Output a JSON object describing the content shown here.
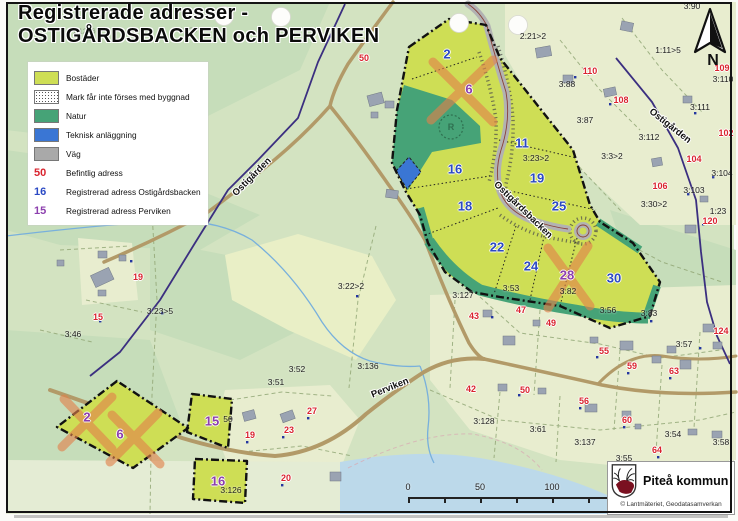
{
  "title": {
    "line1": "Registrerade adresser -",
    "line2": "OSTIGÅRDSBACKEN och PERVIKEN"
  },
  "legend": {
    "items": [
      {
        "type": "bostader",
        "label": "Bostäder"
      },
      {
        "type": "prickmark",
        "label": "Mark får inte förses med byggnad"
      },
      {
        "type": "natur",
        "label": "Natur"
      },
      {
        "type": "teknisk",
        "label": "Teknisk anläggning"
      },
      {
        "type": "vag",
        "label": "Väg"
      },
      {
        "type": "text",
        "color": "red",
        "symbol": "50",
        "label": "Befintlig adress"
      },
      {
        "type": "text",
        "color": "blue",
        "symbol": "16",
        "label": "Registrerad adress Ostigårdsbacken"
      },
      {
        "type": "text",
        "color": "purple",
        "symbol": "15",
        "label": "Registrerad adress Perviken"
      }
    ]
  },
  "colors": {
    "bostader": "#cede55",
    "natur": "#46a377",
    "teknisk": "#3a76d4",
    "vag": "#b2b2b2",
    "befintlig_adress": "#d9232e",
    "adress_ostigardsbacken": "#2b49c4",
    "adress_perviken": "#8c3fae",
    "road_minor": "#b29a68",
    "water": "#bcd9ea",
    "cross_out": "#e2814b"
  },
  "north": {
    "label": "N"
  },
  "scalebar": {
    "labels": [
      {
        "t": "0",
        "x": 8
      },
      {
        "t": "50",
        "x": 80
      },
      {
        "t": "100",
        "x": 152
      },
      {
        "t": "200 m",
        "x": 290
      }
    ]
  },
  "attribution": {
    "municipality": "Piteå kommun",
    "copyright": "© Lantmäteriet, Geodatasamverkan"
  },
  "road_labels": [
    {
      "t": "Ostigården",
      "x": 252,
      "y": 177,
      "r": -45
    },
    {
      "t": "Ostigårdsbacken",
      "x": 523,
      "y": 210,
      "r": 44
    },
    {
      "t": "Ostigården",
      "x": 670,
      "y": 126,
      "r": 38
    },
    {
      "t": "Perviken",
      "x": 390,
      "y": 388,
      "r": -22
    }
  ],
  "parcel_numbers": {
    "ostigardsbacken": [
      {
        "t": "2",
        "x": 447,
        "y": 54
      },
      {
        "t": "11",
        "x": 522,
        "y": 143
      },
      {
        "t": "16",
        "x": 455,
        "y": 169
      },
      {
        "t": "19",
        "x": 537,
        "y": 178
      },
      {
        "t": "18",
        "x": 465,
        "y": 206
      },
      {
        "t": "25",
        "x": 559,
        "y": 206
      },
      {
        "t": "22",
        "x": 497,
        "y": 247
      },
      {
        "t": "24",
        "x": 531,
        "y": 266
      },
      {
        "t": "30",
        "x": 614,
        "y": 278
      }
    ],
    "perviken": [
      {
        "t": "6",
        "x": 469,
        "y": 89
      },
      {
        "t": "28",
        "x": 567,
        "y": 275
      },
      {
        "t": "2",
        "x": 87,
        "y": 417
      },
      {
        "t": "6",
        "x": 120,
        "y": 434
      },
      {
        "t": "15",
        "x": 212,
        "y": 421
      },
      {
        "t": "16",
        "x": 218,
        "y": 481
      }
    ]
  },
  "existing_addresses_red": [
    {
      "t": "50",
      "x": 364,
      "y": 58
    },
    {
      "t": "110",
      "x": 590,
      "y": 71
    },
    {
      "t": "109",
      "x": 722,
      "y": 68
    },
    {
      "t": "108",
      "x": 621,
      "y": 100
    },
    {
      "t": "102",
      "x": 726,
      "y": 133
    },
    {
      "t": "104",
      "x": 694,
      "y": 159
    },
    {
      "t": "106",
      "x": 660,
      "y": 186
    },
    {
      "t": "120",
      "x": 710,
      "y": 221
    },
    {
      "t": "124",
      "x": 721,
      "y": 331
    },
    {
      "t": "43",
      "x": 474,
      "y": 316
    },
    {
      "t": "47",
      "x": 521,
      "y": 310
    },
    {
      "t": "49",
      "x": 551,
      "y": 323
    },
    {
      "t": "55",
      "x": 604,
      "y": 351
    },
    {
      "t": "59",
      "x": 632,
      "y": 366
    },
    {
      "t": "63",
      "x": 674,
      "y": 371
    },
    {
      "t": "50",
      "x": 525,
      "y": 390
    },
    {
      "t": "56",
      "x": 584,
      "y": 401
    },
    {
      "t": "60",
      "x": 627,
      "y": 420
    },
    {
      "t": "64",
      "x": 657,
      "y": 450
    },
    {
      "t": "42",
      "x": 471,
      "y": 389
    },
    {
      "t": "27",
      "x": 312,
      "y": 411
    },
    {
      "t": "23",
      "x": 289,
      "y": 430
    },
    {
      "t": "19",
      "x": 250,
      "y": 435
    },
    {
      "t": "20",
      "x": 286,
      "y": 478
    },
    {
      "t": "19",
      "x": 138,
      "y": 277
    },
    {
      "t": "15",
      "x": 98,
      "y": 317
    },
    {
      "t": "6",
      "x": 731,
      "y": 464
    }
  ],
  "property_labels": [
    {
      "t": "2:21>2",
      "x": 533,
      "y": 36
    },
    {
      "t": "3:90",
      "x": 692,
      "y": 6
    },
    {
      "t": "1:11>5",
      "x": 668,
      "y": 50
    },
    {
      "t": "3:110",
      "x": 723,
      "y": 79
    },
    {
      "t": "3:111",
      "x": 700,
      "y": 107
    },
    {
      "t": "3:112",
      "x": 649,
      "y": 137
    },
    {
      "t": "3:88",
      "x": 567,
      "y": 84
    },
    {
      "t": "3:87",
      "x": 585,
      "y": 120
    },
    {
      "t": "3:104",
      "x": 722,
      "y": 173
    },
    {
      "t": "3:103",
      "x": 694,
      "y": 190
    },
    {
      "t": "3:30>2",
      "x": 654,
      "y": 204
    },
    {
      "t": "1:23",
      "x": 718,
      "y": 211
    },
    {
      "t": "3:3>2",
      "x": 612,
      "y": 156
    },
    {
      "t": "3:23>2",
      "x": 536,
      "y": 158
    },
    {
      "t": "3:22>2",
      "x": 351,
      "y": 286
    },
    {
      "t": "3:127",
      "x": 463,
      "y": 295
    },
    {
      "t": "3:53",
      "x": 511,
      "y": 288
    },
    {
      "t": "3:82",
      "x": 568,
      "y": 291
    },
    {
      "t": "3:56",
      "x": 608,
      "y": 310
    },
    {
      "t": "3:83",
      "x": 649,
      "y": 313
    },
    {
      "t": "3:57",
      "x": 684,
      "y": 344
    },
    {
      "t": "3:23>5",
      "x": 160,
      "y": 311
    },
    {
      "t": "3:46",
      "x": 73,
      "y": 334
    },
    {
      "t": "3:52",
      "x": 297,
      "y": 369
    },
    {
      "t": "3:51",
      "x": 276,
      "y": 382
    },
    {
      "t": "3:136",
      "x": 368,
      "y": 366
    },
    {
      "t": "3:128",
      "x": 484,
      "y": 421
    },
    {
      "t": "3:61",
      "x": 538,
      "y": 429
    },
    {
      "t": "3:137",
      "x": 585,
      "y": 442
    },
    {
      "t": "3:54",
      "x": 673,
      "y": 434
    },
    {
      "t": "3:58",
      "x": 721,
      "y": 442
    },
    {
      "t": "3:55",
      "x": 624,
      "y": 458
    },
    {
      "t": "3:126",
      "x": 231,
      "y": 490
    },
    {
      "t": "50",
      "x": 228,
      "y": 419
    }
  ],
  "property_labels_faint": [
    {
      "t": "1:12>6",
      "x": 84,
      "y": 31
    },
    {
      "t": "3:129",
      "x": 188,
      "y": 30
    }
  ],
  "misc_symbols": [
    {
      "t": "R",
      "x": 451,
      "y": 127
    }
  ]
}
